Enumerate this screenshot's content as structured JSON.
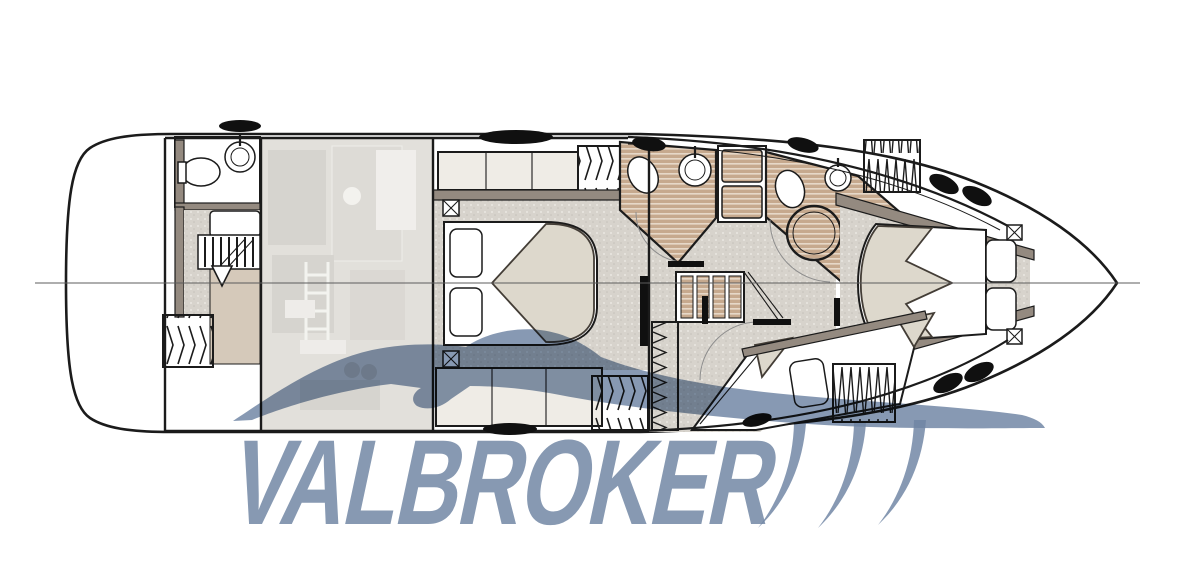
{
  "figure": {
    "kind": "yacht-lower-deck-floor-plan",
    "orientation": "bow-right"
  },
  "watermark": {
    "text": "VALBROKER",
    "color": "#7086a4",
    "elements": [
      "car-silhouette-swoosh",
      "speed-blades",
      "wordmark"
    ]
  },
  "palette": {
    "background": "#ffffff",
    "line": "#1b1b1b",
    "wall": "#948a80",
    "floor_speckle": "#d7d3cc",
    "wood_floor": "#c6a98e",
    "bedding": "#ddd8cc",
    "ghost_area": "#d4d1cb",
    "accent_blue": "#7086a4"
  },
  "plan_features": {
    "aft_head": "toilet, round sink, companionway stairs, vent hatch",
    "engine_room": "ghosted upper-deck equipment view",
    "master_cabin": "double bed with pillows, cabinets, vent hatches",
    "day_head": "toilet, sink, shower column",
    "ensuite_head": "toilet, sink, round shower",
    "companionway": "central staircase",
    "bow_cabin": "v-berth bed with cushions",
    "guest_cabin": "berth with pillow, coil hatch"
  }
}
